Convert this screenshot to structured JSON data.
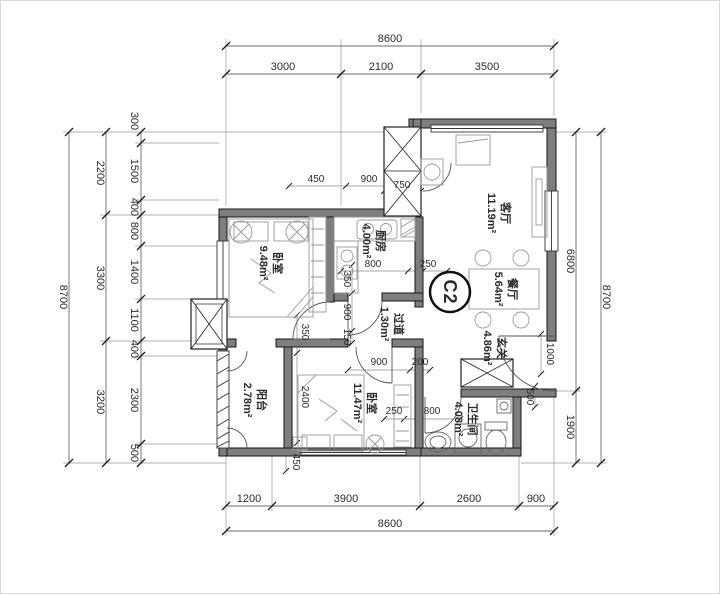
{
  "plan": {
    "unit_label": "C2",
    "rooms": [
      {
        "name": "客厅",
        "area": "11.19m²"
      },
      {
        "name": "餐厅",
        "area": "5.64m²"
      },
      {
        "name": "厨房",
        "area": "4.00m²"
      },
      {
        "name": "过道",
        "area": "1.30m²"
      },
      {
        "name": "玄关",
        "area": "4.86m²"
      },
      {
        "name": "卧室",
        "area": "9.48m²"
      },
      {
        "name": "卧室",
        "area": "11.47m²"
      },
      {
        "name": "阳台",
        "area": "2.78m²"
      },
      {
        "name": "卫生间",
        "area": "4.08m²"
      }
    ],
    "dimensions": {
      "top": {
        "total": "8600",
        "segments": [
          "3000",
          "2100",
          "3500"
        ]
      },
      "bottom": {
        "total": "8600",
        "segments": [
          "1200",
          "3900",
          "2600",
          "900"
        ]
      },
      "left": {
        "total": "8700",
        "mid": [
          "2200",
          "3300",
          "3200"
        ],
        "inner": [
          "300",
          "1500",
          "400",
          "800",
          "1400",
          "1100",
          "400",
          "2300",
          "500"
        ]
      },
      "right": {
        "total": "8700",
        "inner": [
          "6800",
          "1900"
        ]
      },
      "interior": {
        "h": [
          "450",
          "900",
          "750",
          "800",
          "250",
          "900",
          "200",
          "250",
          "800"
        ],
        "v": [
          "350",
          "900",
          "150",
          "350",
          "2400",
          "450",
          "1000",
          "500"
        ]
      }
    },
    "colors": {
      "wall_fill": "#7e7e7e",
      "line": "#333333",
      "background": "#ffffff"
    }
  }
}
